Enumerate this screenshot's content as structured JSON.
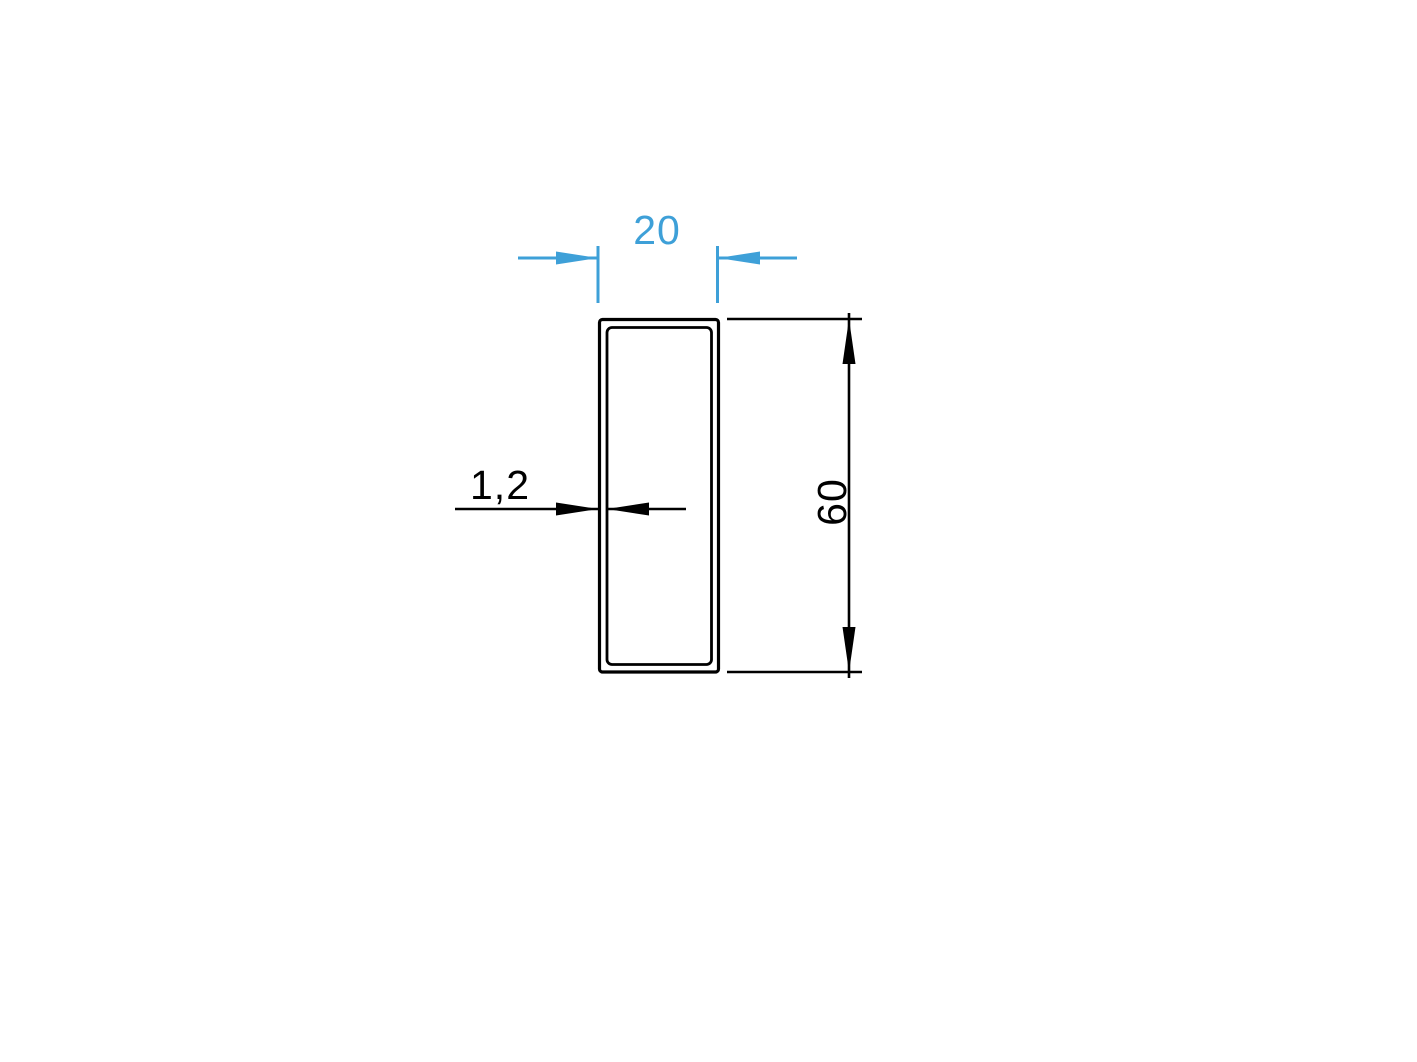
{
  "colors": {
    "dimension_blue": "#3ea0d8",
    "dimension_black": "#000000",
    "profile_outline": "#000000",
    "background": "#ffffff"
  },
  "drawing": {
    "width_dim": {
      "label": "20"
    },
    "height_dim": {
      "label": "60"
    },
    "thickness_dim": {
      "label": "1,2"
    }
  }
}
